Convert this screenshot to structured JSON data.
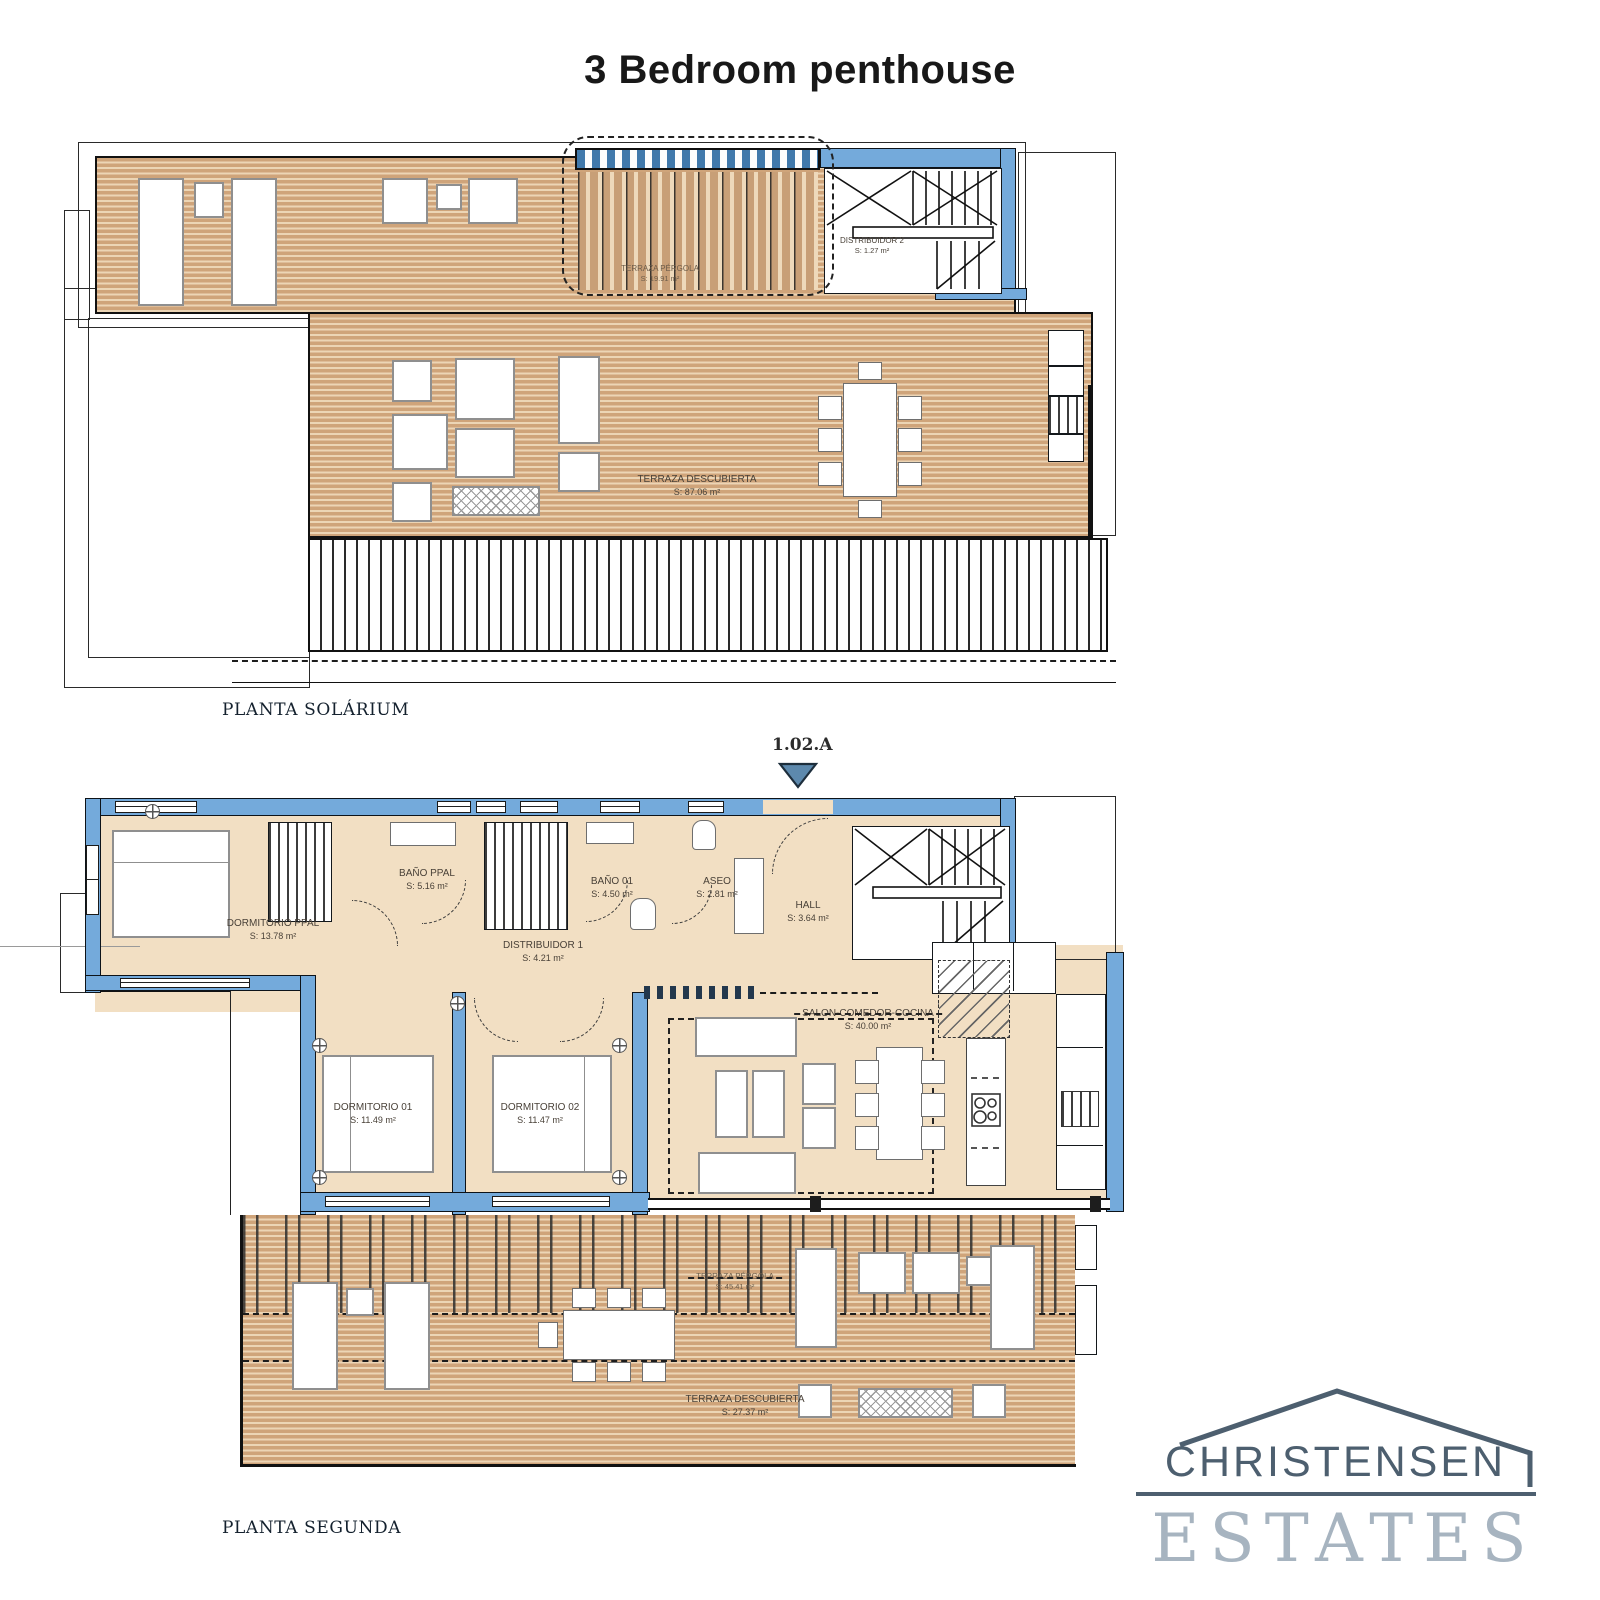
{
  "title": "3 Bedroom penthouse",
  "solarium": {
    "caption": "PLANTA SOLÁRIUM",
    "terraza_descubierta": {
      "name": "TERRAZA DESCUBIERTA",
      "area": "S: 87.06 m²"
    },
    "terraza_pergola": {
      "name": "TERRAZA PÉRGOLA",
      "area": "S: 19.91 m²"
    },
    "distribuidor_2": {
      "name": "DISTRIBUIDOR 2",
      "area": "S: 1.27 m²"
    }
  },
  "unit_marker": "1.02.A",
  "segunda": {
    "caption": "PLANTA SEGUNDA",
    "dormitorio_ppal": {
      "name": "DORMITORIO PPAL",
      "area": "S: 13.78 m²"
    },
    "bano_ppal": {
      "name": "BAÑO PPAL",
      "area": "S: 5.16 m²"
    },
    "bano_01": {
      "name": "BAÑO 01",
      "area": "S: 4.50 m²"
    },
    "aseo": {
      "name": "ASEO",
      "area": "S: 2.81 m²"
    },
    "hall": {
      "name": "HALL",
      "area": "S: 3.64 m²"
    },
    "distribuidor_1": {
      "name": "DISTRIBUIDOR 1",
      "area": "S: 4.21 m²"
    },
    "dormitorio_01": {
      "name": "DORMITORIO 01",
      "area": "S: 11.49 m²"
    },
    "dormitorio_02": {
      "name": "DORMITORIO 02",
      "area": "S: 11.47 m²"
    },
    "salon": {
      "name": "SALON-COMEDOR-COCINA",
      "area": "S: 40.00 m²"
    },
    "terraza_pergola": {
      "name": "TERRAZA PÉRGOLA",
      "area": "S: 45.41 m²"
    },
    "terraza_descubierta": {
      "name": "TERRAZA DESCUBIERTA",
      "area": "S: 27.37 m²"
    }
  },
  "logo": {
    "name": "CHRISTENSEN",
    "type": "ESTATES"
  },
  "colors": {
    "wall": "#74aadb",
    "deck": "#cfa47a",
    "floor": "#f2dfc3",
    "logo_dark": "#4d5f6f",
    "logo_light": "#a7b4c0"
  }
}
